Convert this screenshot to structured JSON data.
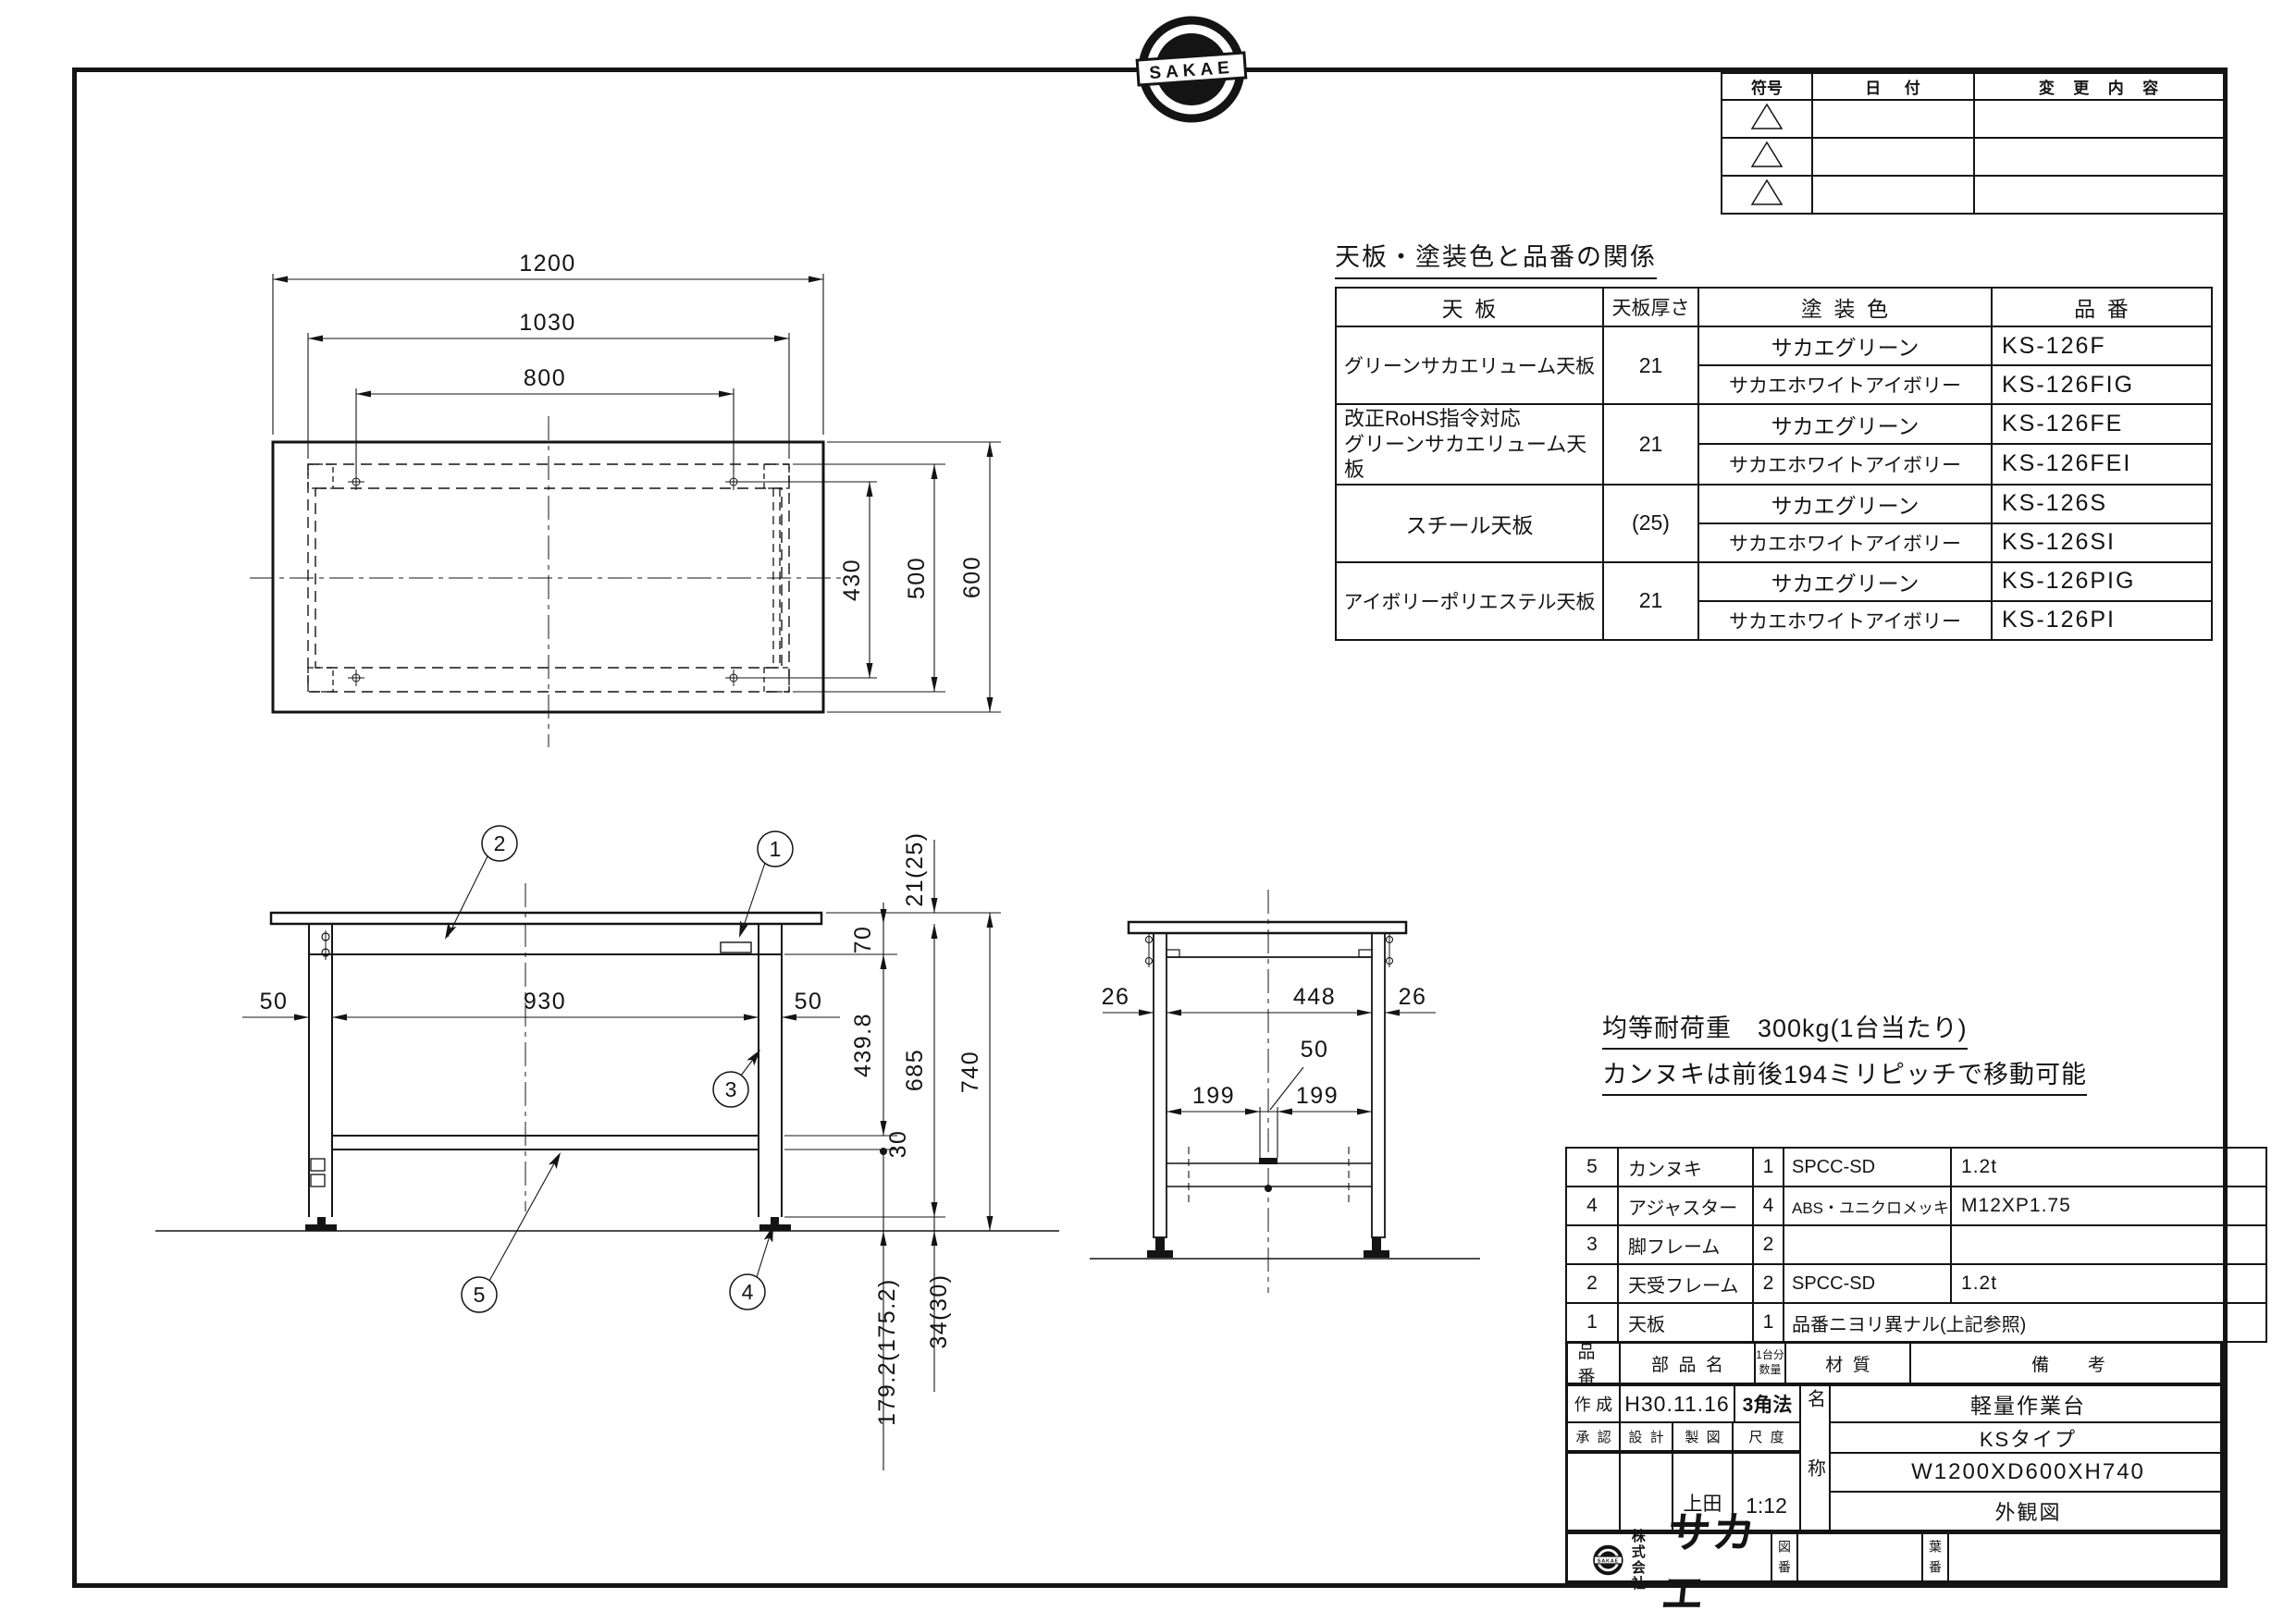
{
  "frame": {
    "logo_text": "SAKAE"
  },
  "revision_table": {
    "col_symbol": "符号",
    "col_date": "日付",
    "col_change": "変更内容"
  },
  "spec_table": {
    "title": "天板・塗装色と品番の関係",
    "col_board": "天板",
    "col_thickness": "天板厚さ",
    "col_color": "塗装色",
    "col_part": "品番",
    "groups": [
      {
        "board": "グリーンサカエリューム天板",
        "thickness": "21",
        "variants": [
          {
            "color": "サカエグリーン",
            "part": "KS-126F"
          },
          {
            "color": "サカエホワイトアイボリー",
            "part": "KS-126FIG"
          }
        ]
      },
      {
        "board": "改正RoHS指令対応\nグリーンサカエリューム天板",
        "thickness": "21",
        "variants": [
          {
            "color": "サカエグリーン",
            "part": "KS-126FE"
          },
          {
            "color": "サカエホワイトアイボリー",
            "part": "KS-126FEI"
          }
        ]
      },
      {
        "board": "スチール天板",
        "thickness": "(25)",
        "variants": [
          {
            "color": "サカエグリーン",
            "part": "KS-126S"
          },
          {
            "color": "サカエホワイトアイボリー",
            "part": "KS-126SI"
          }
        ]
      },
      {
        "board": "アイボリーポリエステル天板",
        "thickness": "21",
        "variants": [
          {
            "color": "サカエグリーン",
            "part": "KS-126PIG"
          },
          {
            "color": "サカエホワイトアイボリー",
            "part": "KS-126PI"
          }
        ]
      }
    ]
  },
  "notes": {
    "load": "均等耐荷重　300kg(1台当たり)",
    "pitch": "カンヌキは前後194ミリピッチで移動可能"
  },
  "parts_table": {
    "col_no": "品番",
    "col_name": "部品名",
    "col_qty": "1台分\n数量",
    "col_material": "材質",
    "col_remarks": "備考",
    "rows": [
      {
        "no": "5",
        "name": "カンヌキ",
        "qty": "1",
        "material": "SPCC-SD",
        "remarks": "1.2t"
      },
      {
        "no": "4",
        "name": "アジャスター",
        "qty": "4",
        "material": "ABS・ユニクロメッキ",
        "remarks": "M12XP1.75"
      },
      {
        "no": "3",
        "name": "脚フレーム",
        "qty": "2",
        "material": "",
        "remarks": ""
      },
      {
        "no": "2",
        "name": "天受フレーム",
        "qty": "2",
        "material": "SPCC-SD",
        "remarks": "1.2t"
      },
      {
        "no": "1",
        "name": "天板",
        "qty": "1",
        "material": "品番ニヨリ異ナル(上記参照)",
        "remarks": ""
      }
    ]
  },
  "title_block": {
    "created_label": "作成",
    "created_date": "H30.11.16",
    "projection": "3角法",
    "approved_label": "承認",
    "design_label": "設計",
    "draft_label": "製図",
    "scale_label": "尺度",
    "drafter": "上田",
    "scale": "1:12",
    "name_label": "名称",
    "product": "軽量作業台",
    "type": "KSタイプ",
    "size": "W1200XD600XH740",
    "view": "外観図",
    "drawing_no_label": "図番",
    "sheet_no_label": "葉番",
    "company_prefix": "株式会社",
    "company_name": "サカエ"
  },
  "drawings": {
    "balloons": [
      "1",
      "2",
      "3",
      "4",
      "5"
    ],
    "top": {
      "width": "1200",
      "frame_width": "1030",
      "span_w": "800",
      "span_d": "430",
      "frame_depth": "500",
      "depth": "600"
    },
    "front": {
      "leg_w_l": "50",
      "inner_span": "930",
      "leg_w_r": "50",
      "top_t": "21(25)",
      "frame_h": "70",
      "upper_h": "439.8",
      "clear_h": "685",
      "height": "740",
      "bar_t": "30",
      "bar_floor": "179.2(175.2)",
      "foot_h": "34(30)"
    },
    "side": {
      "leg_l": "26",
      "inner": "448",
      "leg_r": "26",
      "bar_w": "50",
      "pitch_l": "199",
      "pitch_r": "199"
    }
  }
}
